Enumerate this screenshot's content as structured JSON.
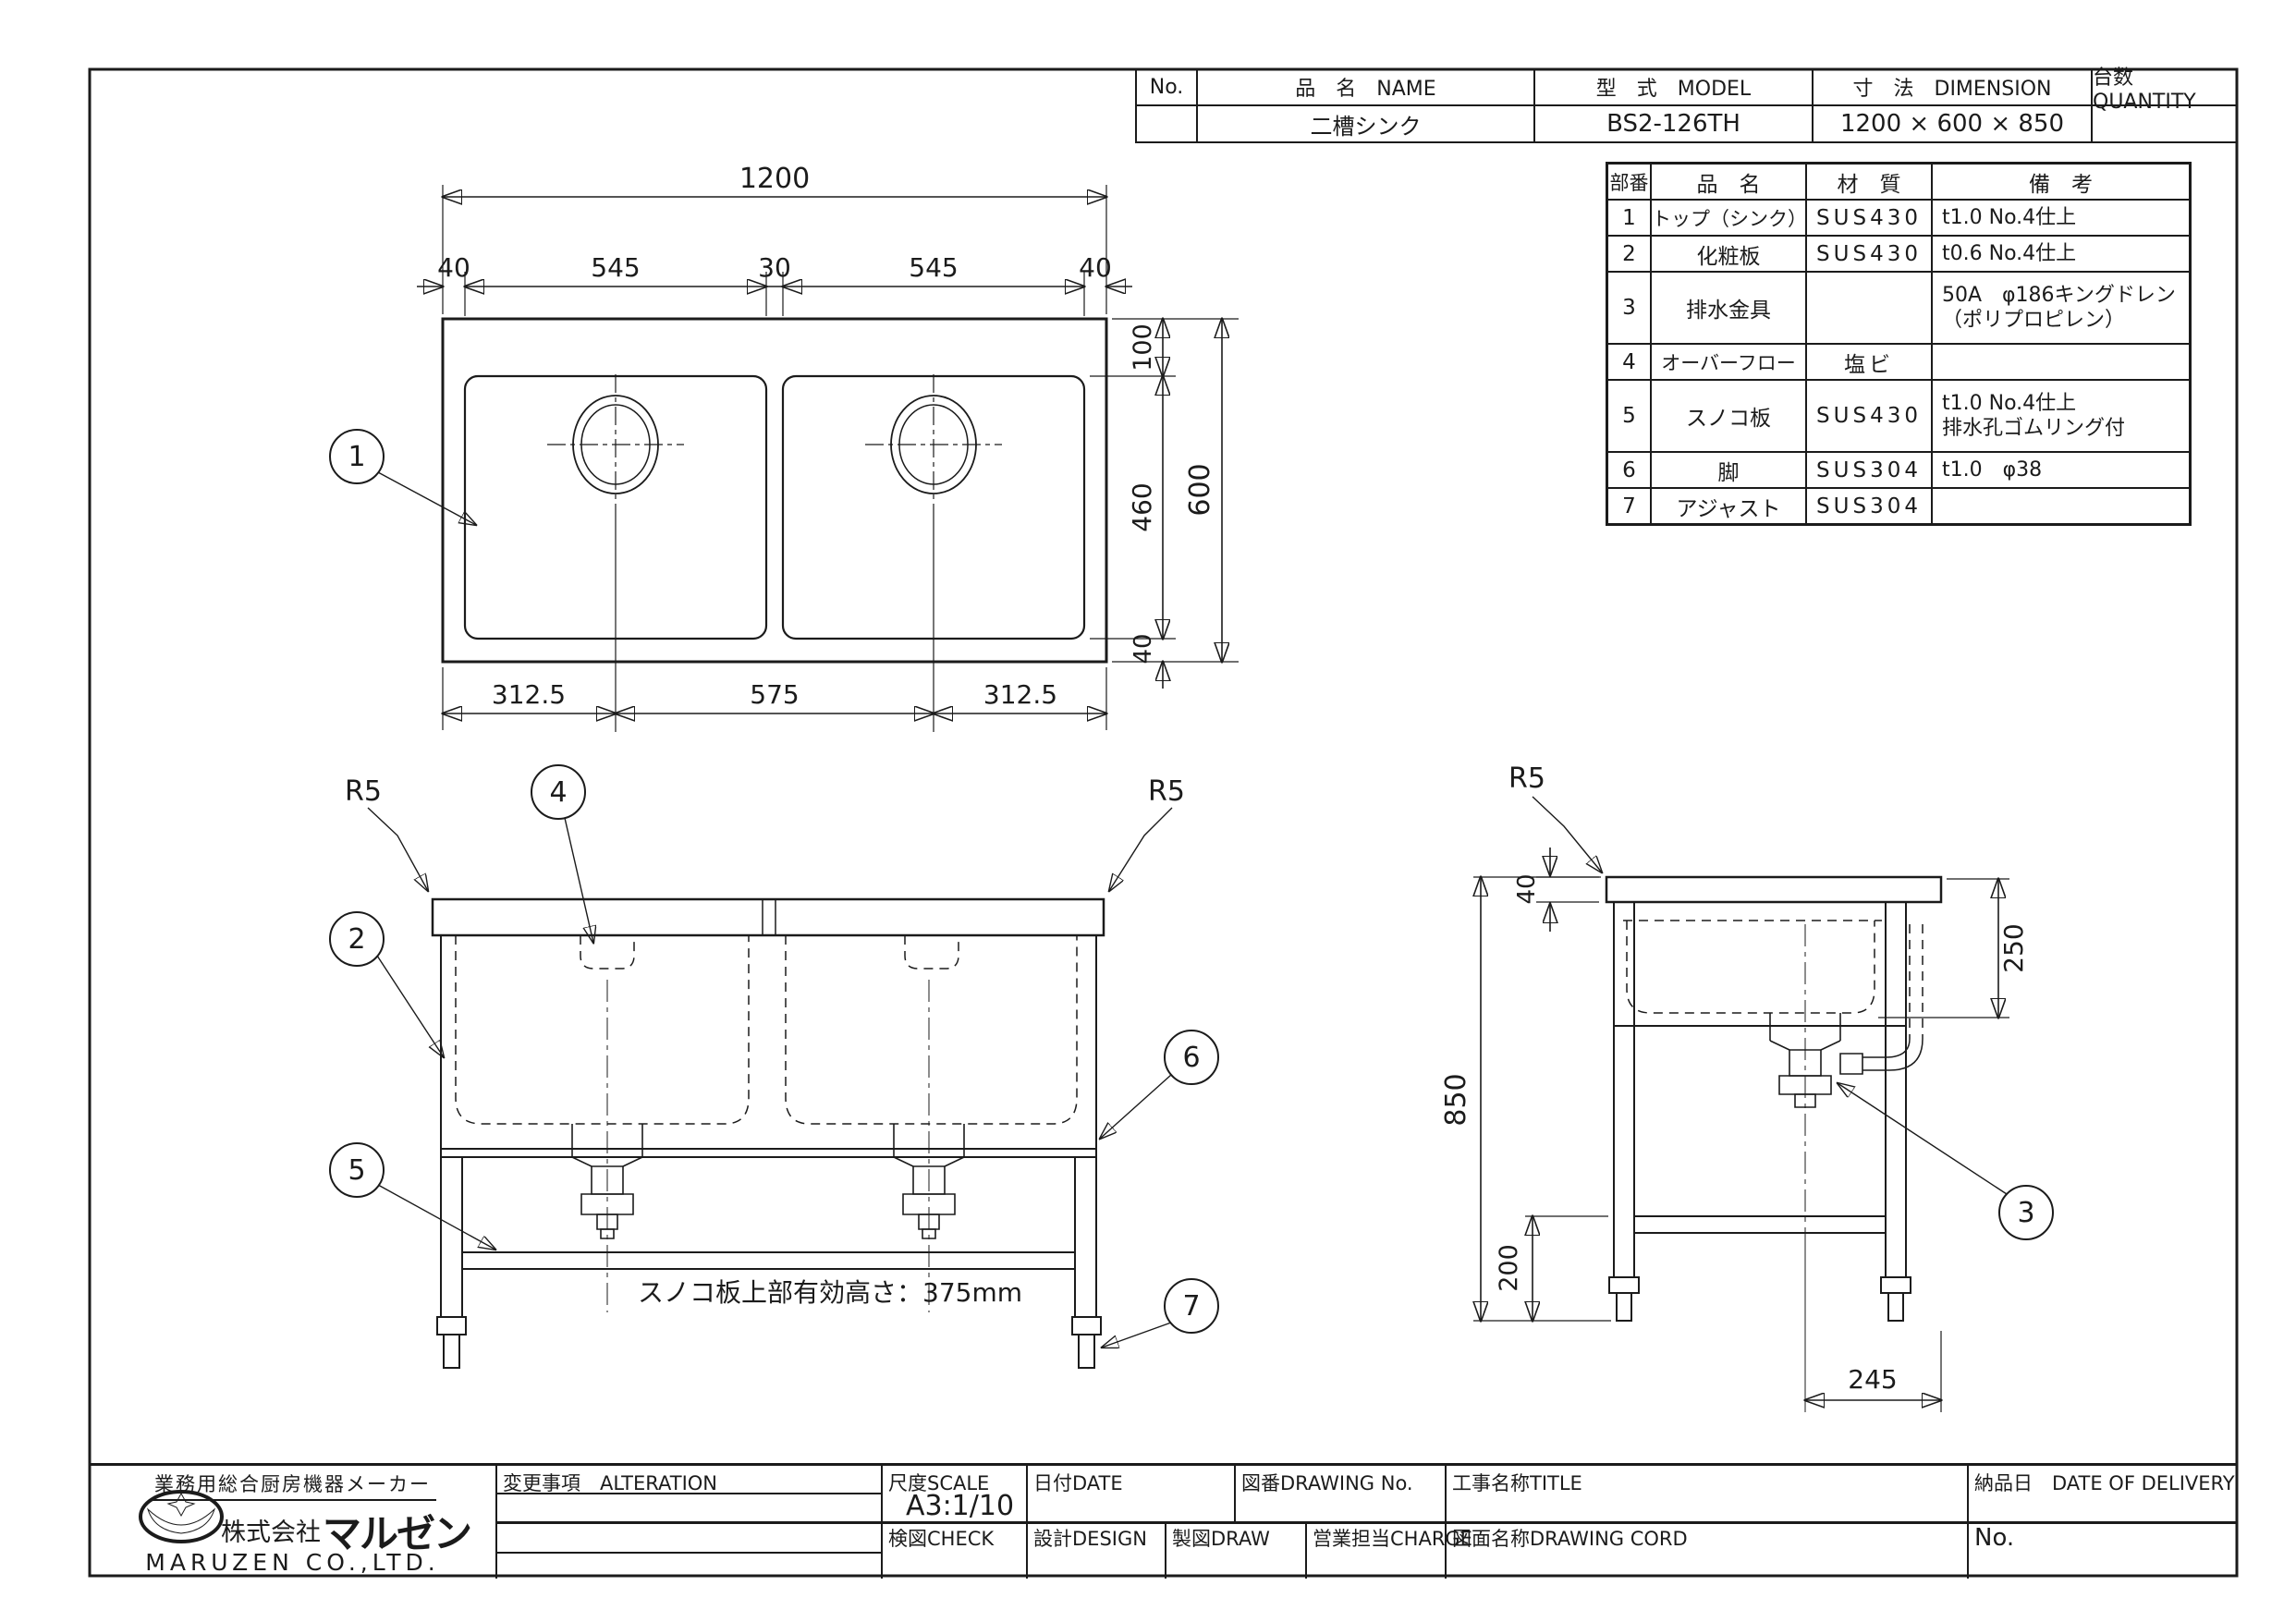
{
  "colors": {
    "ink": "#1b1b1b",
    "paper": "#ffffff"
  },
  "header_table": {
    "headers": {
      "no": "No.",
      "name": "品　名　NAME",
      "model": "型　式　MODEL",
      "dimension": "寸　法　DIMENSION",
      "quantity": "台数 QUANTITY"
    },
    "row": {
      "no": "",
      "name": "二槽シンク",
      "model": "BS2-126TH",
      "dimension": "1200 × 600 × 850",
      "quantity": ""
    }
  },
  "parts_table": {
    "headers": {
      "ref": "部番",
      "name": "品　名",
      "material": "材　質",
      "remarks": "備　考"
    },
    "rows": [
      {
        "ref": "1",
        "name": "トップ（シンク）",
        "material": "SUS430",
        "remarks": "t1.0 No.4仕上"
      },
      {
        "ref": "2",
        "name": "化粧板",
        "material": "SUS430",
        "remarks": "t0.6 No.4仕上"
      },
      {
        "ref": "3",
        "name": "排水金具",
        "material": "",
        "remarks": "50A　φ186キングドレン\n（ポリプロピレン）"
      },
      {
        "ref": "4",
        "name": "オーバーフロー",
        "material": "塩ビ",
        "remarks": ""
      },
      {
        "ref": "5",
        "name": "スノコ板",
        "material": "SUS430",
        "remarks": "t1.0 No.4仕上\n排水孔ゴムリング付"
      },
      {
        "ref": "6",
        "name": "脚",
        "material": "SUS304",
        "remarks": "t1.0　φ38"
      },
      {
        "ref": "7",
        "name": "アジャスト",
        "material": "SUS304",
        "remarks": ""
      }
    ]
  },
  "top_view": {
    "balloon": "1",
    "dim_width": "1200",
    "dim_left_margin": "40",
    "dim_bowl_left": "545",
    "dim_center_gap": "30",
    "dim_bowl_right": "545",
    "dim_right_margin": "40",
    "dim_back": "100",
    "dim_bowl_depth": "460",
    "dim_front": "40",
    "dim_depth": "600",
    "dim_bottom_left": "312.5",
    "dim_bottom_center": "575",
    "dim_bottom_right": "312.5"
  },
  "front_view": {
    "r5_left": "R5",
    "r5_right": "R5",
    "balloon_panel": "2",
    "balloon_overflow": "4",
    "balloon_slat": "5",
    "balloon_leg": "6",
    "balloon_adjuster": "7",
    "note": "スノコ板上部有効高さ：375mm"
  },
  "side_view": {
    "r5": "R5",
    "dim_top": "40",
    "dim_splash": "250",
    "dim_height": "850",
    "dim_shelf": "200",
    "dim_drain": "245",
    "balloon_drain": "3"
  },
  "title_block": {
    "tagline": "業務用総合厨房機器メーカー",
    "company_prefix": "株式会社",
    "company_logo_text": "マルゼン",
    "company_en": "MARUZEN CO.,LTD.",
    "alteration_label": "変更事項　ALTERATION",
    "scale_label": "尺度SCALE",
    "scale_value": "A3:1/10",
    "date_label": "日付DATE",
    "drawing_no_label": "図番DRAWING No.",
    "title_label": "工事名称TITLE",
    "delivery_label": "納品日　DATE OF DELIVERY",
    "check_label": "検図CHECK",
    "design_label": "設計DESIGN",
    "draw_label": "製図DRAW",
    "charge_label": "営業担当CHARGE",
    "drawing_name_label": "図面名称DRAWING CORD",
    "no_label": "No."
  }
}
